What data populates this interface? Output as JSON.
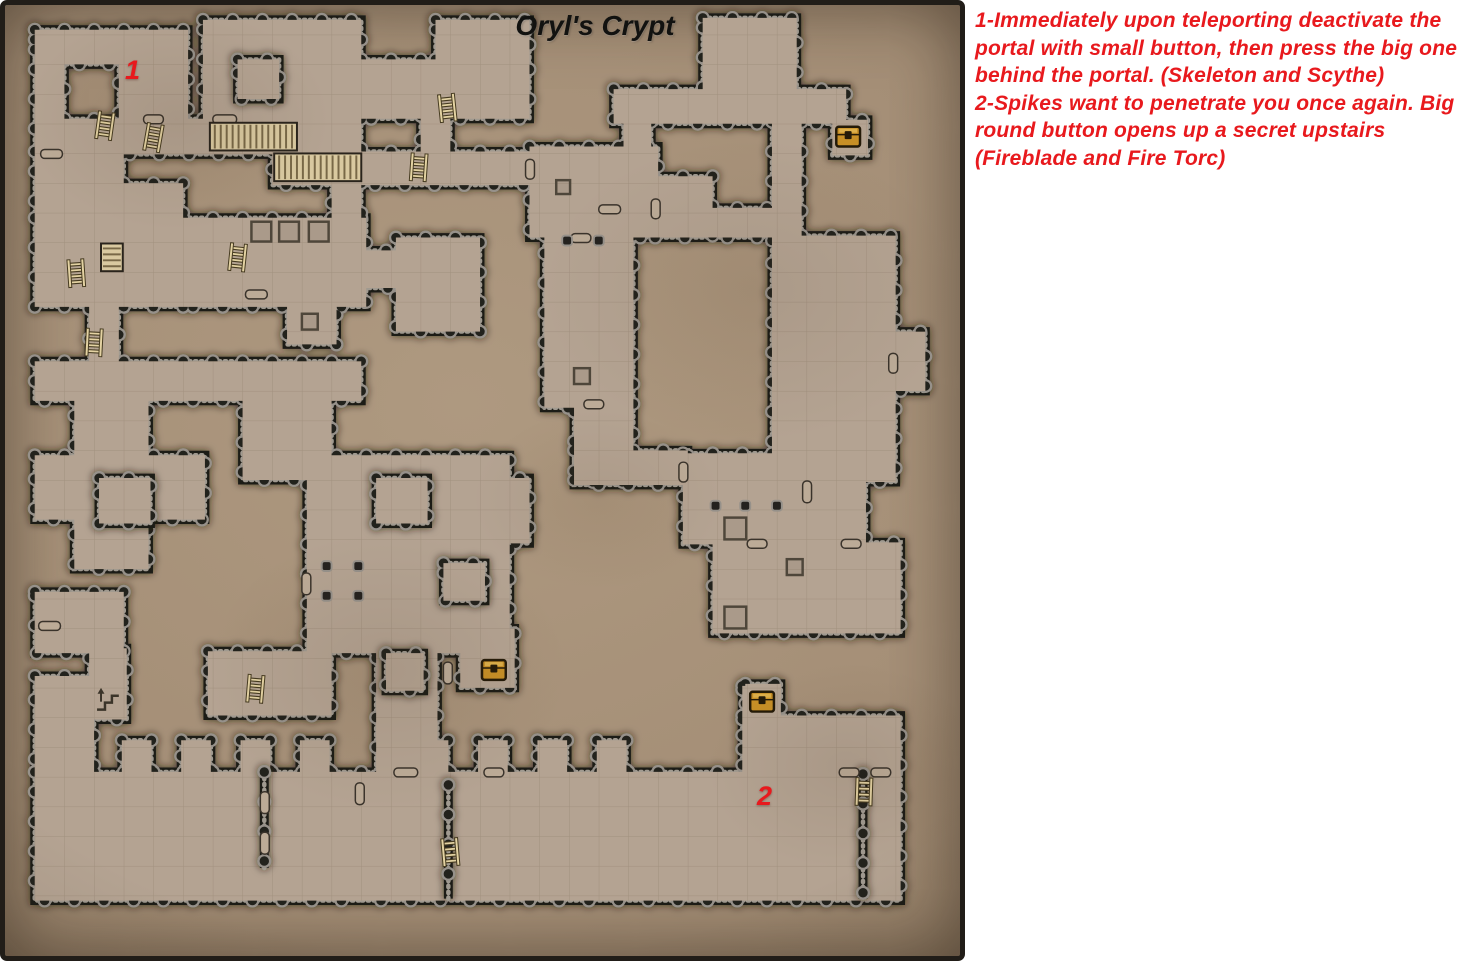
{
  "title": "Oryl's Crypt",
  "notes": [
    {
      "text": "1-Immediately upon teleporting deactivate the portal with small button, then press the big one behind the portal. (Skeleton and Scythe)"
    },
    {
      "text": "2-Spikes want to penetrate you once again. Big round button opens up a secret upstairs (Fireblade and Fire Torc)"
    }
  ],
  "markers": [
    {
      "label": "1",
      "x": 120,
      "y": 52
    },
    {
      "label": "2",
      "x": 752,
      "y": 778
    }
  ],
  "colors": {
    "accent_red": "#e8191d",
    "title_color": "#121210",
    "wall": "#1f1c18",
    "knob_ring": "#96918a",
    "knob_core": "#24221f",
    "rivet": "#a09a90",
    "floor": "#b4a392",
    "grid_line": "#8d7d6a",
    "door_fill": "#bcab97",
    "door_edge": "#3a332b",
    "chest_gold": "#c78f26",
    "chest_dark": "#241a08",
    "stair_light": "#d9c9a0",
    "stair_dark": "#786847",
    "stair_edge": "#2a241c",
    "pit": "#4e463a",
    "wood": "#453a20",
    "wood_light": "#e3d2a2",
    "shadow": "#241a0f"
  },
  "map": {
    "width": 965,
    "height": 961,
    "grid": 30,
    "rooms": [
      [
        30,
        25,
        155,
        35
      ],
      [
        30,
        25,
        30,
        125
      ],
      [
        115,
        55,
        70,
        62
      ],
      [
        60,
        115,
        300,
        36
      ],
      [
        60,
        150,
        60,
        68
      ],
      [
        270,
        148,
        260,
        34
      ],
      [
        200,
        15,
        160,
        100
      ],
      [
        360,
        55,
        170,
        60
      ],
      [
        435,
        15,
        95,
        45
      ],
      [
        330,
        150,
        30,
        70
      ],
      [
        30,
        148,
        30,
        70
      ],
      [
        30,
        215,
        150,
        90
      ],
      [
        60,
        180,
        120,
        38
      ],
      [
        180,
        215,
        185,
        90
      ],
      [
        355,
        248,
        42,
        38
      ],
      [
        395,
        235,
        85,
        95
      ],
      [
        85,
        303,
        30,
        62
      ],
      [
        285,
        303,
        50,
        40
      ],
      [
        30,
        360,
        330,
        40
      ],
      [
        70,
        395,
        75,
        175
      ],
      [
        30,
        455,
        172,
        65
      ],
      [
        240,
        398,
        90,
        82
      ],
      [
        305,
        455,
        205,
        200
      ],
      [
        460,
        478,
        70,
        66
      ],
      [
        460,
        630,
        55,
        60
      ],
      [
        375,
        630,
        62,
        148
      ],
      [
        705,
        13,
        95,
        75
      ],
      [
        615,
        85,
        235,
        35
      ],
      [
        836,
        116,
        36,
        36
      ],
      [
        775,
        118,
        30,
        120
      ],
      [
        530,
        143,
        130,
        92
      ],
      [
        545,
        233,
        90,
        174
      ],
      [
        655,
        173,
        60,
        62
      ],
      [
        710,
        205,
        70,
        30
      ],
      [
        625,
        116,
        28,
        30
      ],
      [
        775,
        233,
        125,
        249
      ],
      [
        895,
        330,
        35,
        60
      ],
      [
        575,
        403,
        60,
        79
      ],
      [
        575,
        450,
        115,
        35
      ],
      [
        685,
        453,
        185,
        92
      ],
      [
        715,
        543,
        125,
        92
      ],
      [
        838,
        543,
        67,
        92
      ],
      [
        30,
        593,
        90,
        62
      ],
      [
        85,
        650,
        38,
        72
      ],
      [
        30,
        678,
        60,
        102
      ],
      [
        30,
        775,
        330,
        130
      ],
      [
        360,
        775,
        545,
        130
      ],
      [
        205,
        653,
        125,
        65
      ],
      [
        748,
        686,
        36,
        34
      ],
      [
        745,
        688,
        32,
        90
      ],
      [
        745,
        718,
        160,
        60
      ],
      [
        420,
        112,
        30,
        42
      ],
      [
        118,
        743,
        30,
        38
      ],
      [
        178,
        743,
        30,
        38
      ],
      [
        238,
        743,
        30,
        38
      ],
      [
        298,
        743,
        30,
        38
      ],
      [
        418,
        743,
        30,
        38
      ],
      [
        478,
        743,
        30,
        38
      ],
      [
        538,
        743,
        30,
        38
      ],
      [
        598,
        743,
        30,
        38
      ]
    ],
    "islands": [
      [
        235,
        55,
        42,
        40
      ],
      [
        95,
        478,
        52,
        46
      ],
      [
        375,
        478,
        52,
        46
      ],
      [
        443,
        564,
        42,
        38
      ],
      [
        385,
        655,
        38,
        38
      ]
    ],
    "inner_walls": [
      [
        262,
        775,
        262,
        872
      ],
      [
        448,
        788,
        448,
        903
      ],
      [
        867,
        777,
        867,
        903
      ]
    ],
    "doors": [
      [
        36,
        146,
        22,
        9
      ],
      [
        34,
        623,
        22,
        9
      ],
      [
        600,
        202,
        22,
        9
      ],
      [
        258,
        795,
        9,
        22
      ],
      [
        258,
        836,
        9,
        22
      ],
      [
        806,
        481,
        9,
        22
      ],
      [
        243,
        288,
        22,
        9
      ],
      [
        484,
        771,
        20,
        9
      ],
      [
        843,
        771,
        20,
        9
      ],
      [
        140,
        111,
        20,
        9
      ],
      [
        210,
        111,
        24,
        9
      ],
      [
        526,
        156,
        9,
        20
      ],
      [
        585,
        399,
        20,
        9
      ],
      [
        393,
        771,
        24,
        9
      ],
      [
        681,
        462,
        9,
        20
      ],
      [
        893,
        352,
        9,
        20
      ],
      [
        845,
        540,
        20,
        9
      ],
      [
        750,
        540,
        20,
        9
      ],
      [
        875,
        771,
        20,
        9
      ],
      [
        572,
        231,
        20,
        9
      ],
      [
        653,
        196,
        9,
        20
      ],
      [
        354,
        786,
        9,
        22
      ],
      [
        300,
        574,
        9,
        22
      ],
      [
        443,
        664,
        9,
        22
      ]
    ],
    "chests": [
      [
        852,
        133
      ],
      [
        494,
        672
      ],
      [
        765,
        704
      ]
    ],
    "ladders": [
      [
        101,
        122,
        8
      ],
      [
        150,
        134,
        10
      ],
      [
        447,
        104,
        -6
      ],
      [
        418,
        164,
        4
      ],
      [
        235,
        255,
        6
      ],
      [
        72,
        271,
        -4
      ],
      [
        90,
        341,
        3
      ],
      [
        253,
        691,
        5
      ],
      [
        450,
        856,
        -5
      ],
      [
        868,
        795,
        2
      ]
    ],
    "stairs": [
      [
        207,
        119,
        88,
        28,
        "h"
      ],
      [
        272,
        150,
        88,
        28,
        "h"
      ],
      [
        97,
        241,
        22,
        28,
        "v"
      ]
    ],
    "stairs_up": [
      [
        96,
        694
      ]
    ],
    "pits": [
      [
        249,
        219,
        20
      ],
      [
        277,
        219,
        20
      ],
      [
        307,
        219,
        20
      ],
      [
        300,
        312,
        16
      ],
      [
        727,
        518,
        22
      ],
      [
        790,
        560,
        16
      ],
      [
        727,
        608,
        22
      ],
      [
        575,
        367,
        16
      ],
      [
        557,
        177,
        14
      ]
    ],
    "pillars": [
      [
        325,
        567
      ],
      [
        357,
        567
      ],
      [
        325,
        597
      ],
      [
        357,
        597
      ],
      [
        718,
        506
      ],
      [
        748,
        506
      ],
      [
        780,
        506
      ],
      [
        568,
        238
      ],
      [
        600,
        238
      ]
    ]
  }
}
